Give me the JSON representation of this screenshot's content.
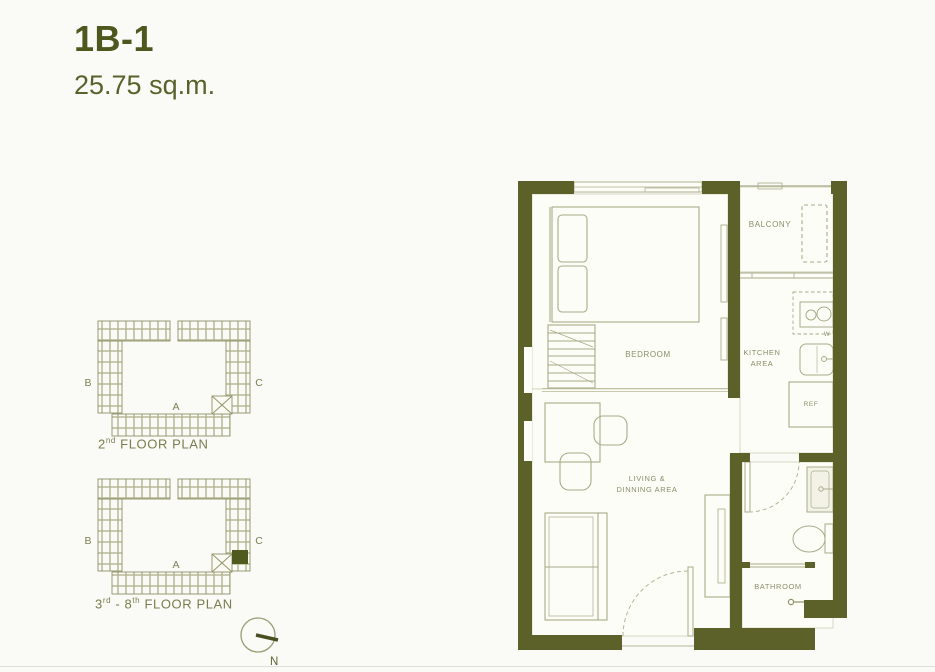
{
  "header": {
    "unit_name": "1B-1",
    "unit_area": "25.75 sq.m."
  },
  "mini_plans": {
    "plan1": {
      "wing_left": "B",
      "wing_right": "C",
      "wing_bottom": "A",
      "label_num": "2",
      "label_sup": "nd",
      "label_mid": "",
      "label_sup2": "",
      "label_rest": " FLOOR PLAN"
    },
    "plan2": {
      "wing_left": "B",
      "wing_right": "C",
      "wing_bottom": "A",
      "label_num": "3",
      "label_sup": "rd",
      "label_mid": " - 8",
      "label_sup2": "th",
      "label_rest": " FLOOR PLAN"
    }
  },
  "compass": {
    "north": "N"
  },
  "unit_plan": {
    "labels": {
      "bedroom": "BEDROOM",
      "balcony": "BALCONY",
      "kitchen_1": "KITCHEN",
      "kitchen_2": "AREA",
      "living_1": "LIVING &",
      "living_2": "DINNING AREA",
      "bathroom": "BATHROOM",
      "fridge": "REF",
      "stove_mark": "W"
    }
  },
  "colors": {
    "wall": "#5b6129",
    "title": "#4d571e",
    "furniture_line": "#a9ac88",
    "room_label": "#8b8e66"
  }
}
